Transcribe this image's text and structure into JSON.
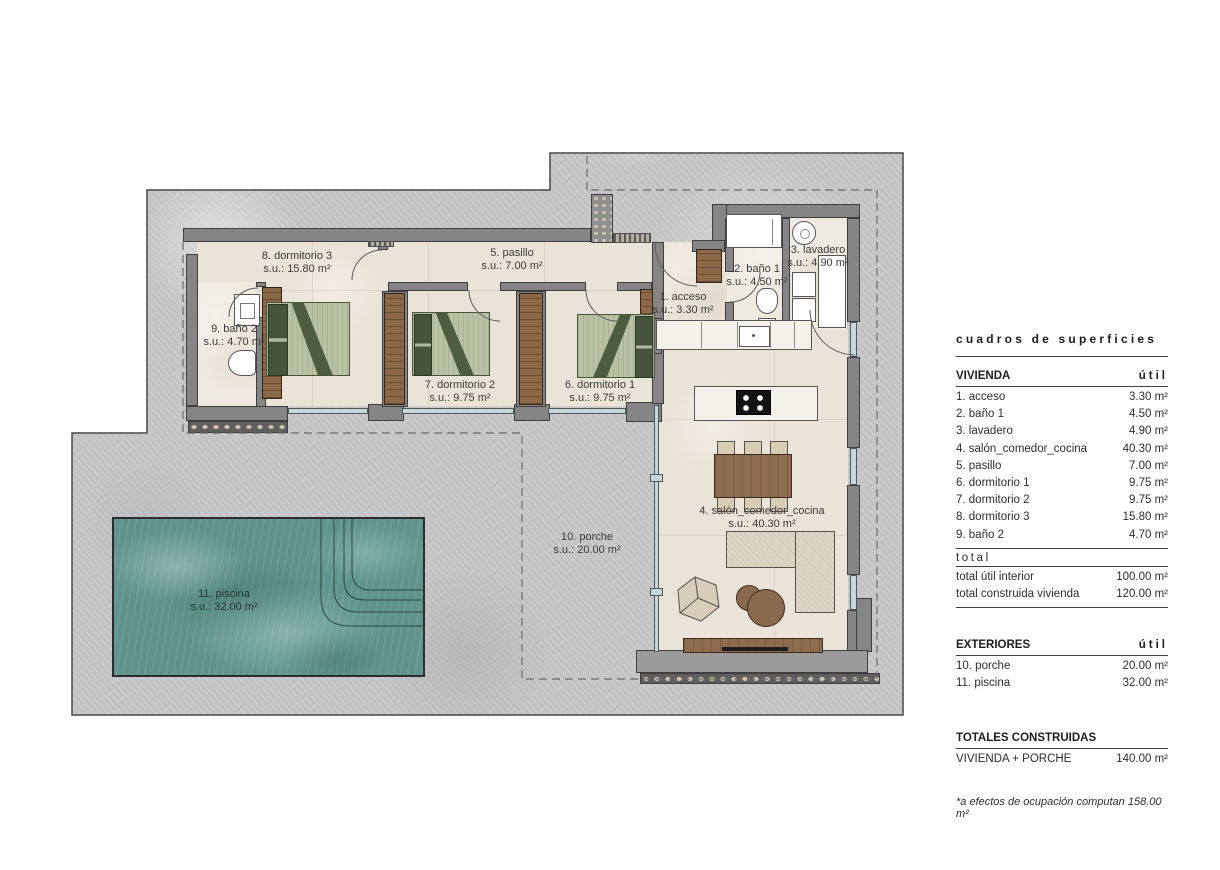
{
  "plan": {
    "labels": [
      {
        "name": "1. acceso",
        "area": "s.u.: 3.30 m²"
      },
      {
        "name": "2. baño 1",
        "area": "s.u.: 4.50 m²"
      },
      {
        "name": "3. lavadero",
        "area": "s.u.: 4.90 m²"
      },
      {
        "name": "4. salón_comedor_cocina",
        "area": "s.u.: 40.30 m²"
      },
      {
        "name": "5. pasillo",
        "area": "s.u.: 7.00 m²"
      },
      {
        "name": "6. dormitorio 1",
        "area": "s.u.: 9.75 m²"
      },
      {
        "name": "7. dormitorio 2",
        "area": "s.u.: 9.75 m²"
      },
      {
        "name": "8. dormitorio 3",
        "area": "s.u.: 15.80 m²"
      },
      {
        "name": "9. baño 2",
        "area": "s.u.: 4.70 m²"
      },
      {
        "name": "10. porche",
        "area": "s.u.: 20.00 m²"
      },
      {
        "name": "11. piscina",
        "area": "s.u.: 32.00 m²"
      }
    ]
  },
  "panel": {
    "title": "cuadros de superficies",
    "vivienda": {
      "header": "VIVIENDA",
      "unit": "útil",
      "rows": [
        {
          "label": "1. acceso",
          "value": "3.30 m²"
        },
        {
          "label": "2. baño 1",
          "value": "4.50 m²"
        },
        {
          "label": "3. lavadero",
          "value": "4.90 m²"
        },
        {
          "label": "4. salón_comedor_cocina",
          "value": "40.30 m²"
        },
        {
          "label": "5. pasillo",
          "value": "7.00 m²"
        },
        {
          "label": "6. dormitorio 1",
          "value": "9.75 m²"
        },
        {
          "label": "7. dormitorio 2",
          "value": "9.75 m²"
        },
        {
          "label": "8. dormitorio 3",
          "value": "15.80 m²"
        },
        {
          "label": "9. baño 2",
          "value": "4.70 m²"
        }
      ],
      "total_label": "total",
      "totals": [
        {
          "label": "total útil interior",
          "value": "100.00 m²"
        },
        {
          "label": "total construida vivienda",
          "value": "120.00 m²"
        }
      ]
    },
    "exteriores": {
      "header": "EXTERIORES",
      "unit": "útil",
      "rows": [
        {
          "label": "10. porche",
          "value": "20.00 m²"
        },
        {
          "label": "11. piscina",
          "value": "32.00 m²"
        }
      ]
    },
    "totales": {
      "header": "TOTALES CONSTRUIDAS",
      "rows": [
        {
          "label": "VIVIENDA + PORCHE",
          "value": "140.00 m²"
        }
      ]
    },
    "footnote": "*a efectos de ocupación computan 158.00 m²"
  },
  "colors": {
    "plot": "#c7c7c7",
    "wall": "#858585",
    "floor": "#eae3d7",
    "water": "#5e948b",
    "wood": "#8a6848",
    "bed_green": "#b9c3a4"
  }
}
